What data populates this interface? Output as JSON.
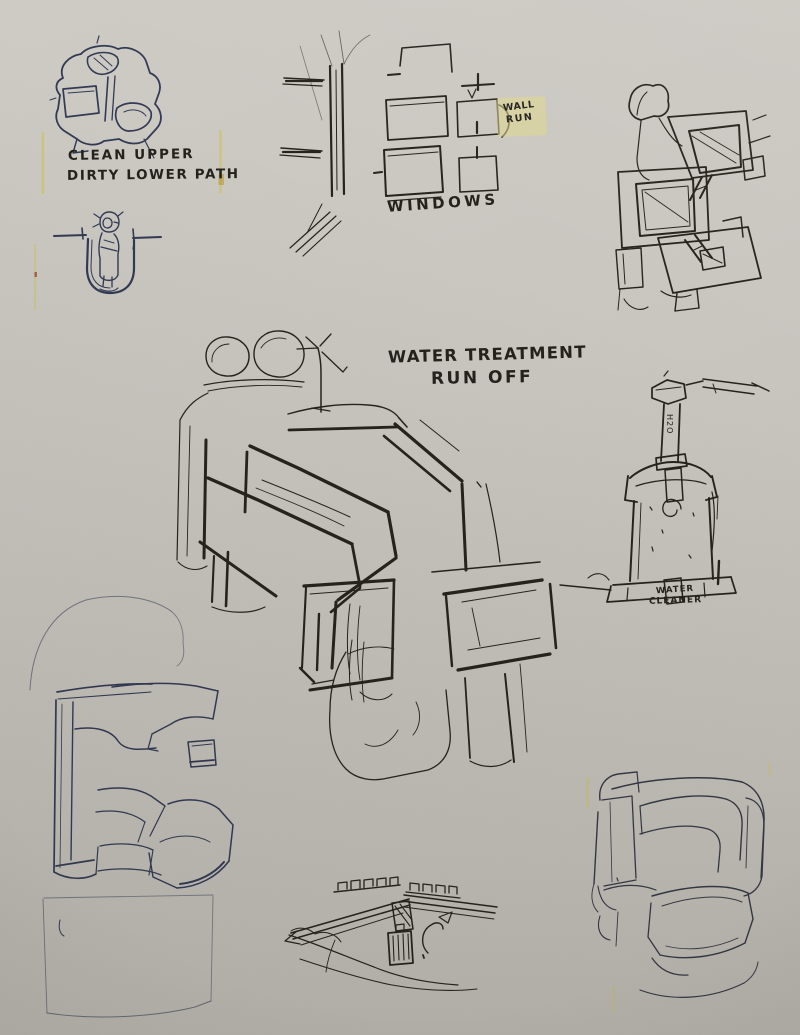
{
  "page": {
    "paper_color": "#c9c6c0",
    "ink_blue": "#323a54",
    "ink_black": "#26231d",
    "highlight_yellow": "#e0d78c"
  },
  "annotations": {
    "clean_dirty": {
      "line1": "CLEAN UPPER",
      "line2": "DIRTY LOWER PATH"
    },
    "windows": {
      "label": "WINDOWS"
    },
    "wall_run": {
      "line1": "WALL",
      "line2": "RUN"
    },
    "water_treatment": {
      "line1": "WATER TREATMENT",
      "line2": "RUN OFF"
    },
    "water_cleaner": {
      "line1": "WATER",
      "line2": "CLEANER"
    },
    "h2o_pipe": {
      "label": "H2O"
    }
  }
}
